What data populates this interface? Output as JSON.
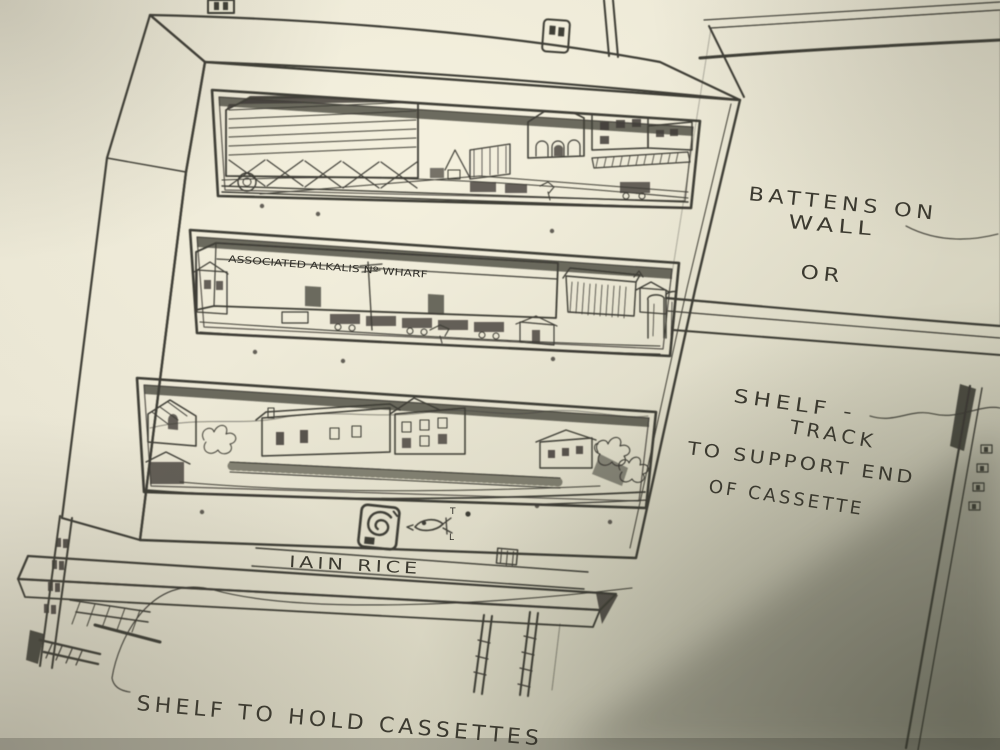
{
  "annotations": {
    "battens_line1": "BATTENS ON",
    "battens_line2": "WALL",
    "or_label": "OR",
    "shelf_track_line1": "SHELF -",
    "shelf_track_line2": "TRACK",
    "support_line1": "TO SUPPORT END",
    "support_line2": "OF CASSETTE",
    "shelf_caption": "SHELF TO HOLD CASSETTES",
    "signature": "IAIN RICE",
    "warehouse_sign": "ASSOCIATED ALKALIS Nº WHARF",
    "fish_mark_top": "T",
    "fish_mark_bottom": "L"
  },
  "colors": {
    "paper_light": "#f0ecdc",
    "paper_mid": "#d8d4c0",
    "paper_dark": "#b0ae9c",
    "ink": "#32302a",
    "shadow": "#56564a"
  }
}
